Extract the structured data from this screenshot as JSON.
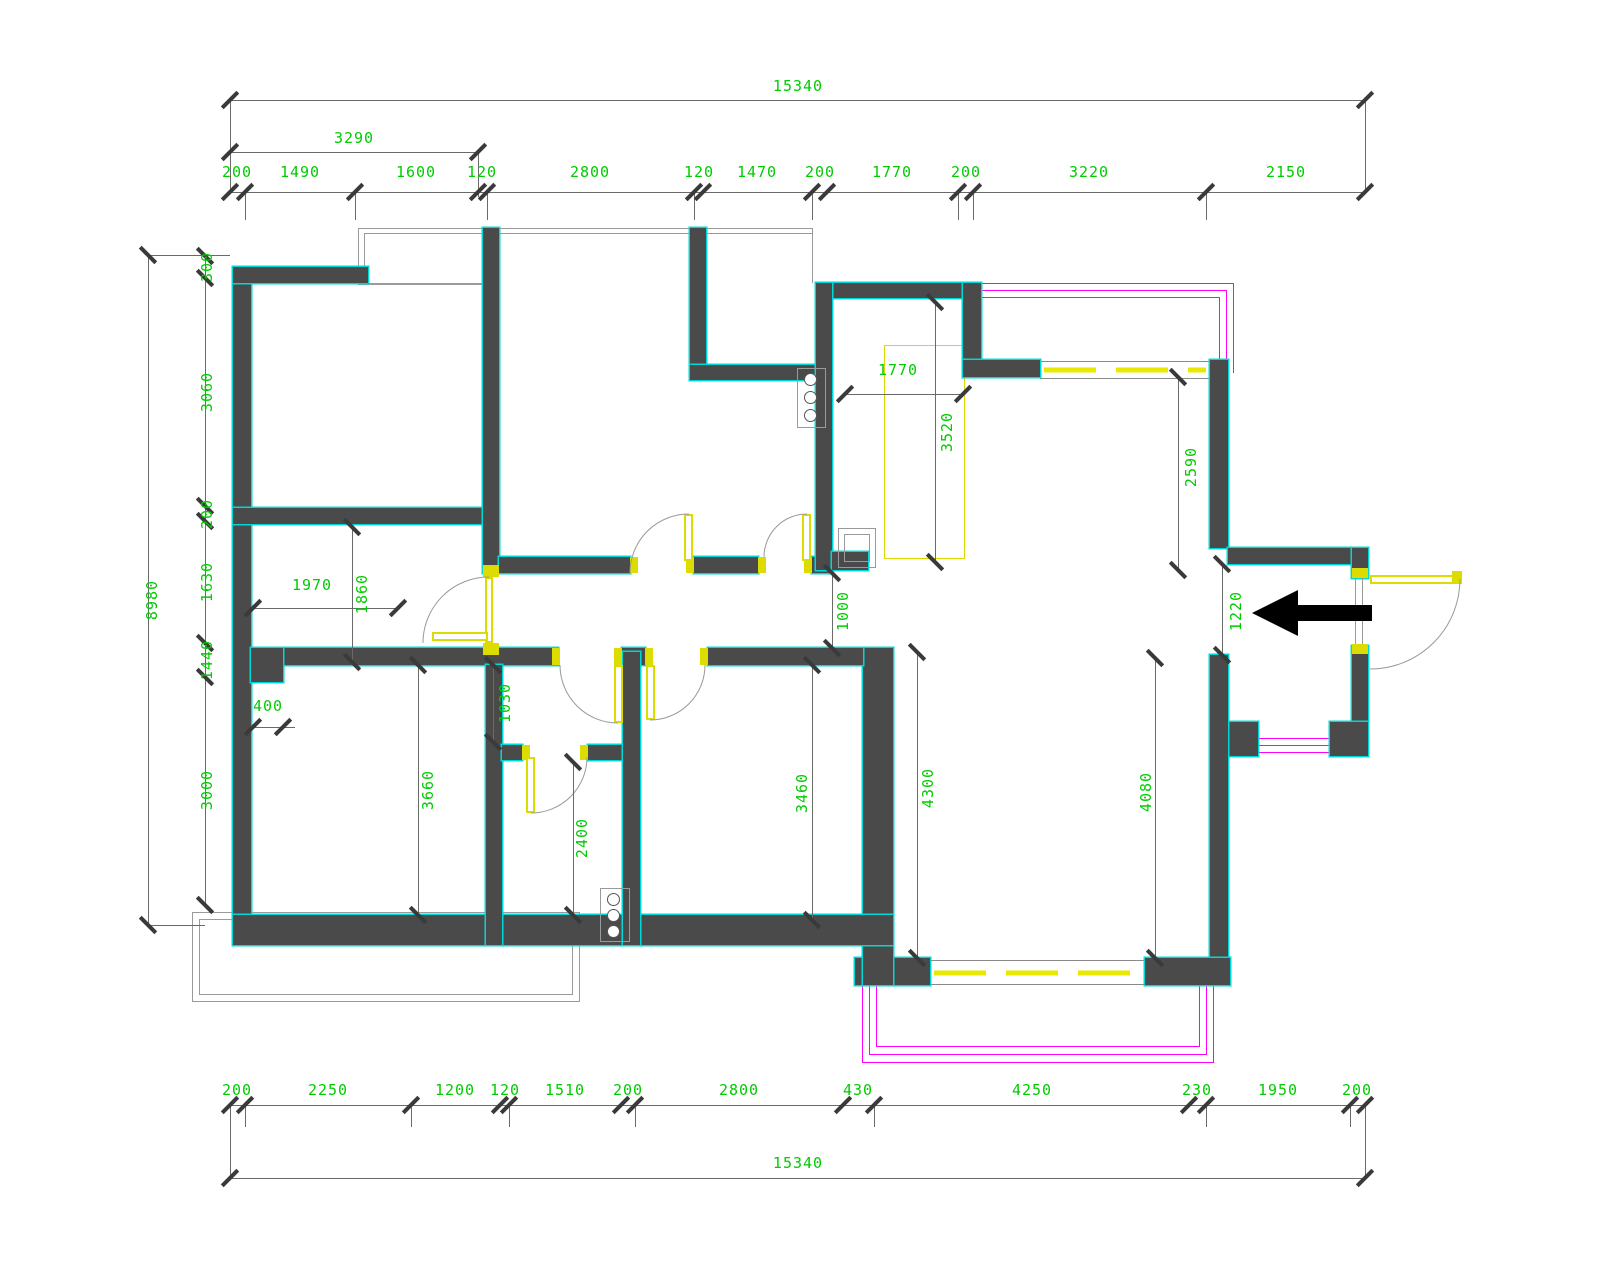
{
  "drawing": {
    "type": "residential floor plan (CAD)",
    "units": "mm",
    "colors": {
      "wall": "#4a4a4a",
      "wall_edge": "#00d8d8",
      "dimension_text": "#00cc00",
      "door_window": "#dcdc00",
      "bay_window": "#ff00ff",
      "lines": "#6a6a6a"
    },
    "dims": {
      "top_total": "15340",
      "top_sub": "3290",
      "top_chain": [
        "200",
        "1490",
        "1600",
        "120",
        "2800",
        "120",
        "1470",
        "200",
        "1770",
        "200",
        "3220",
        "2150"
      ],
      "bottom_chain": [
        "200",
        "2250",
        "1200",
        "120",
        "1510",
        "200",
        "2800",
        "430",
        "4250",
        "230",
        "1950",
        "200"
      ],
      "bottom_total": "15340",
      "left_outer": "8980",
      "left_chain": [
        "300",
        "3060",
        "200",
        "1630",
        "1440",
        "3000"
      ],
      "interior": {
        "hall_width": "1970",
        "hall_height": "1860",
        "pier": "400",
        "nook": "1030",
        "room_left": "3660",
        "bathroom": "2400",
        "bedroom3": "3460",
        "living_left": "4300",
        "living_right": "4080",
        "kitchen_width": "1770",
        "kitchen_height": "3520",
        "window_right": "2590",
        "hall_passage": "1000",
        "entry_passage": "1220"
      }
    }
  }
}
